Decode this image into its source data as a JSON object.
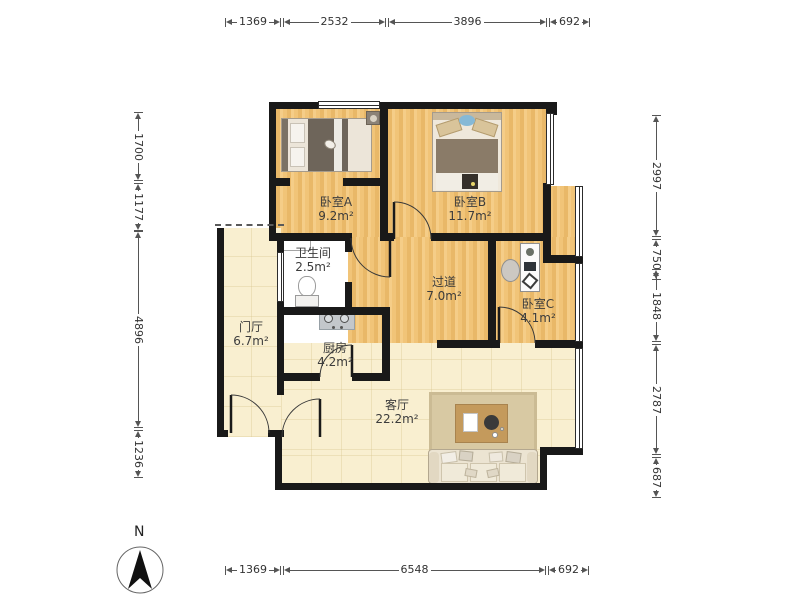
{
  "compass": {
    "n": "N"
  },
  "dims": {
    "top": [
      "1369",
      "2532",
      "3896",
      "692"
    ],
    "bottom": [
      "1369",
      "6548",
      "692"
    ],
    "left": [
      "1700",
      "1177",
      "4896",
      "1236"
    ],
    "right": [
      "2997",
      "750",
      "1848",
      "2787",
      "687"
    ]
  },
  "rooms": {
    "bedroomA": {
      "name": "卧室A",
      "area": "9.2m²"
    },
    "bedroomB": {
      "name": "卧室B",
      "area": "11.7m²"
    },
    "bedroomC": {
      "name": "卧室C",
      "area": "4.1m²"
    },
    "bathroom": {
      "name": "卫生间",
      "area": "2.5m²"
    },
    "hallway": {
      "name": "过道",
      "area": "7.0m²"
    },
    "foyer": {
      "name": "门厅",
      "area": "6.7m²"
    },
    "kitchen": {
      "name": "厨房",
      "area": "4.2m²"
    },
    "living": {
      "name": "客厅",
      "area": "22.2m²"
    }
  },
  "colors": {
    "wall": "#191919",
    "wood_floor": "#f1c478",
    "tile_floor": "#f7f6f3",
    "cream_floor": "#f9efd0",
    "dimension": "#555555"
  }
}
